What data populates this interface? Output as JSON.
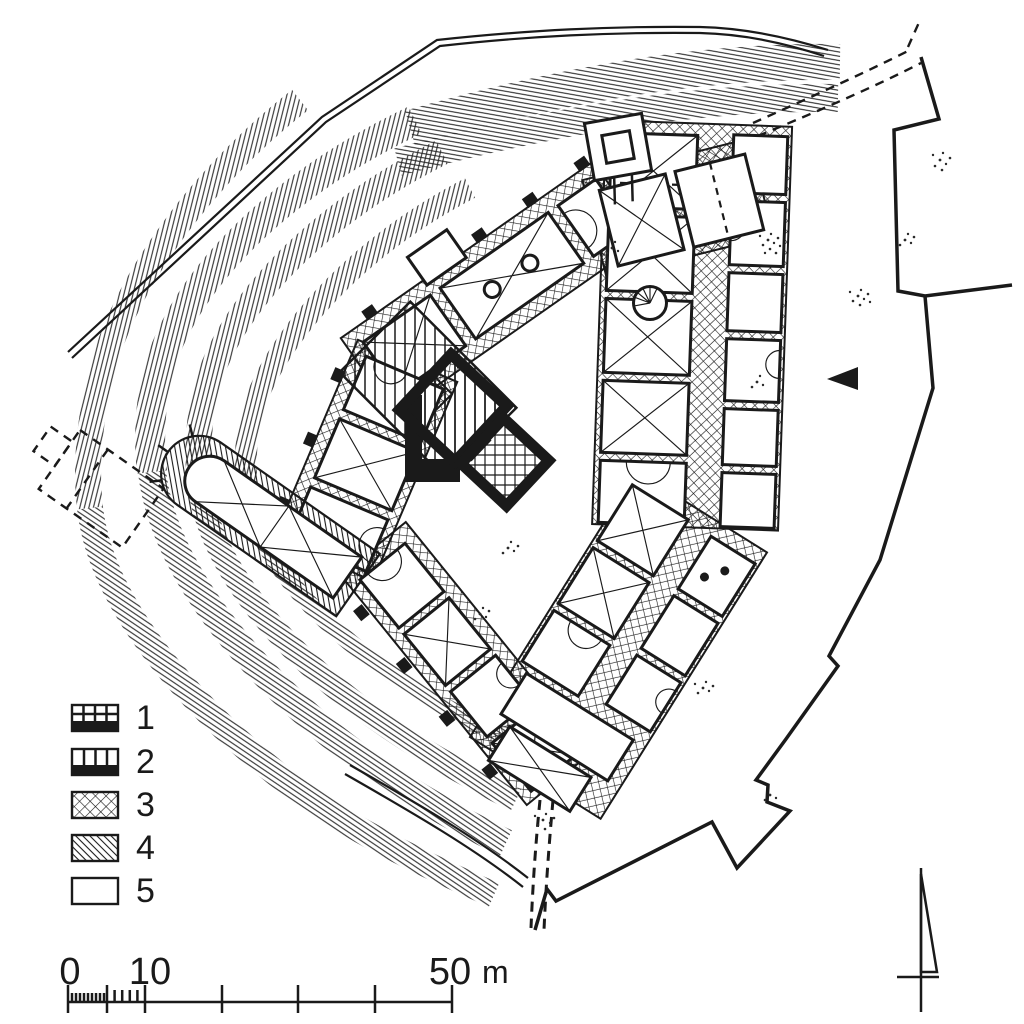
{
  "figure": {
    "kind": "castle-ground-plan",
    "paper_color": "#ffffff",
    "ink_color": "#1a1a1a"
  },
  "legend": {
    "items": [
      {
        "label": "1",
        "swatch": "grid-cells-over-black-bar"
      },
      {
        "label": "2",
        "swatch": "vertical-cells-over-black-bar"
      },
      {
        "label": "3",
        "swatch": "diamond-crosshatch"
      },
      {
        "label": "4",
        "swatch": "diagonal-hatch"
      },
      {
        "label": "5",
        "swatch": "empty"
      }
    ]
  },
  "scale_bar": {
    "zero": "0",
    "ten": "10",
    "fifty": "50",
    "unit": "m",
    "major_ticks_m": [
      0,
      5,
      10,
      20,
      30,
      40,
      50
    ]
  },
  "markers": {
    "north_arrow": "north-arrow",
    "entrance": "entrance-triangle"
  }
}
